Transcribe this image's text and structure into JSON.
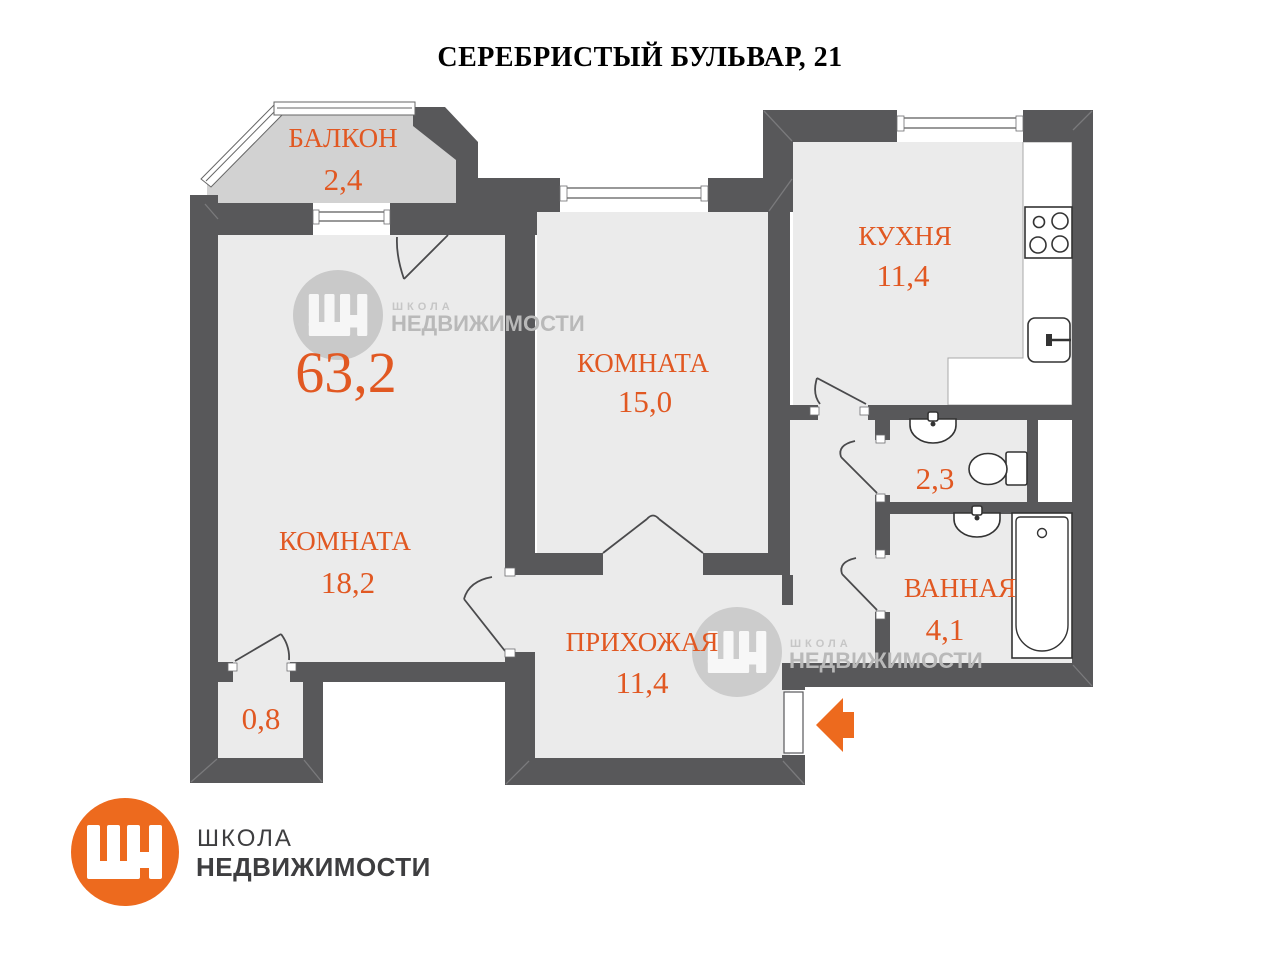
{
  "title": "СЕРЕБРИСТЫЙ БУЛЬВАР, 21",
  "total_area": "63,2",
  "rooms": {
    "balcony": {
      "name": "БАЛКОН",
      "area": "2,4"
    },
    "room_18": {
      "name": "КОМНАТА",
      "area": "18,2"
    },
    "room_15": {
      "name": "КОМНАТА",
      "area": "15,0"
    },
    "kitchen": {
      "name": "КУХНЯ",
      "area": "11,4"
    },
    "hallway": {
      "name": "ПРИХОЖАЯ",
      "area": "11,4"
    },
    "bathroom": {
      "name": "ВАННАЯ",
      "area": "4,1"
    },
    "wc": {
      "area": "2,3"
    },
    "storage": {
      "area": "0,8"
    }
  },
  "watermark": {
    "line1": "ШКОЛА",
    "line2": "НЕДВИЖИМОСТИ"
  },
  "logo": {
    "line1": "ШКОЛА",
    "line2": "НЕДВИЖИМОСТИ"
  },
  "colors": {
    "accent_text": "#E15822",
    "brand_orange": "#ED6A1E",
    "walls": "#58585A",
    "floor": "#EBEBEB",
    "balcony_floor": "#D2D2D2"
  }
}
